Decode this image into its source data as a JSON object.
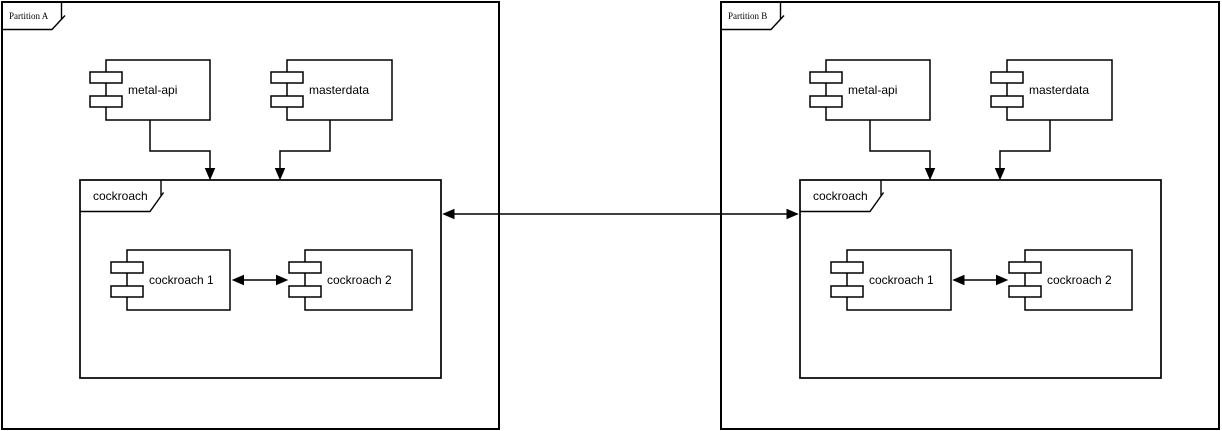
{
  "diagram_type": "uml-component-deployment-diagram",
  "colors": {
    "background": "#ffffff",
    "stroke": "#000000",
    "text": "#000000"
  },
  "partition_a": {
    "label": "Partition A",
    "components": {
      "metal_api": {
        "label": "metal-api"
      },
      "masterdata": {
        "label": "masterdata"
      }
    },
    "package": {
      "label": "cockroach",
      "components": {
        "cockroach_1": {
          "label": "cockroach 1"
        },
        "cockroach_2": {
          "label": "cockroach 2"
        }
      }
    }
  },
  "partition_b": {
    "label": "Partition B",
    "components": {
      "metal_api": {
        "label": "metal-api"
      },
      "masterdata": {
        "label": "masterdata"
      }
    },
    "package": {
      "label": "cockroach",
      "components": {
        "cockroach_1": {
          "label": "cockroach 1"
        },
        "cockroach_2": {
          "label": "cockroach 2"
        }
      }
    }
  },
  "connections": [
    {
      "from": "metal-api (Partition A)",
      "to": "cockroach (Partition A)",
      "style": "arrow"
    },
    {
      "from": "masterdata (Partition A)",
      "to": "cockroach (Partition A)",
      "style": "arrow"
    },
    {
      "from": "cockroach 1 (Partition A)",
      "to": "cockroach 2 (Partition A)",
      "style": "bidirectional-arrow"
    },
    {
      "from": "metal-api (Partition B)",
      "to": "cockroach (Partition B)",
      "style": "arrow"
    },
    {
      "from": "masterdata (Partition B)",
      "to": "cockroach (Partition B)",
      "style": "arrow"
    },
    {
      "from": "cockroach 1 (Partition B)",
      "to": "cockroach 2 (Partition B)",
      "style": "bidirectional-arrow"
    },
    {
      "from": "cockroach (Partition A)",
      "to": "cockroach (Partition B)",
      "style": "bidirectional-arrow"
    }
  ]
}
